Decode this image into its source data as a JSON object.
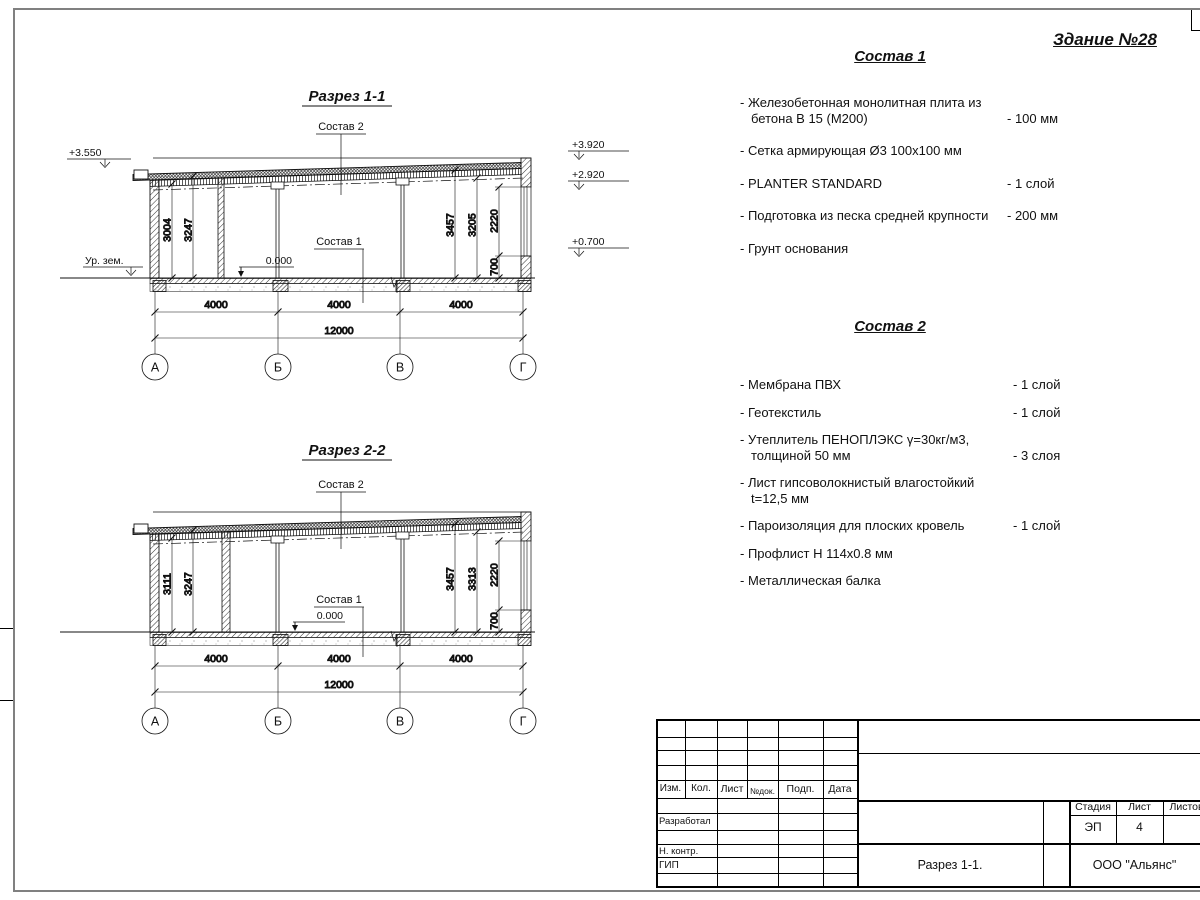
{
  "sheet": {
    "building_title": "Здание №28"
  },
  "section1": {
    "title": "Разрез 1-1",
    "labels": {
      "sostav2": "Состав 2",
      "sostav1": "Состав 1",
      "zero": "0.000",
      "ground": "Ур. зем."
    },
    "elev_left": "+3.550",
    "elev_right": [
      "+3.920",
      "+2.920",
      "+0.700"
    ],
    "dims_left": [
      "3004",
      "3247"
    ],
    "dims_right": [
      "3457",
      "3205",
      "2220",
      "700"
    ],
    "dims_bottom": [
      "4000",
      "4000",
      "4000"
    ],
    "dim_total": "12000",
    "axes": [
      "А",
      "Б",
      "В",
      "Г"
    ]
  },
  "section2": {
    "title": "Разрез 2-2",
    "labels": {
      "sostav2": "Состав 2",
      "sostav1": "Состав 1",
      "zero": "0.000"
    },
    "dims_left": [
      "3111",
      "3247"
    ],
    "dims_right": [
      "3457",
      "3313",
      "2220",
      "700"
    ],
    "dims_bottom": [
      "4000",
      "4000",
      "4000"
    ],
    "dim_total": "12000",
    "axes": [
      "А",
      "Б",
      "В",
      "Г"
    ]
  },
  "sostav1": {
    "title": "Состав 1",
    "items": [
      {
        "text": "Железобетонная  монолитная плита из бетона В 15 (М200)",
        "value": "- 100 мм"
      },
      {
        "text": "Сетка армирующая Ø3 100х100 мм",
        "value": ""
      },
      {
        "text": "PLANTER STANDARD",
        "value": "- 1  слой"
      },
      {
        "text": "Подготовка из песка средней крупности",
        "value": "- 200 мм"
      },
      {
        "text": "Грунт основания",
        "value": ""
      }
    ]
  },
  "sostav2": {
    "title": "Состав 2",
    "items": [
      {
        "text": "Мембрана ПВХ",
        "value": "- 1 слой"
      },
      {
        "text": "Геотекстиль",
        "value": "- 1 слой"
      },
      {
        "text": "Утеплитель ПЕНОПЛЭКС γ=30кг/м3, толщиной 50 мм",
        "value": "- 3 слоя"
      },
      {
        "text": "Лист гипсоволокнистый влагостойкий t=12,5 мм",
        "value": ""
      },
      {
        "text": "Пароизоляция для плоских кровель",
        "value": "- 1 слой"
      },
      {
        "text": "Профлист Н 114х0.8 мм",
        "value": ""
      },
      {
        "text": "Металлическая балка",
        "value": ""
      }
    ]
  },
  "titleblock": {
    "change_cols": [
      "Изм.",
      "Кол.",
      "Лист",
      "№док.",
      "Подп.",
      "Дата"
    ],
    "role_rows": [
      "Разработал",
      "Н. контр.",
      "ГИП"
    ],
    "stage_label": "Стадия",
    "sheet_label": "Лист",
    "sheets_label": "Листов",
    "stage_value": "ЭП",
    "sheet_value": "4",
    "doc_title": "Разрез 1-1.",
    "company": "ООО \"Альянс\""
  }
}
